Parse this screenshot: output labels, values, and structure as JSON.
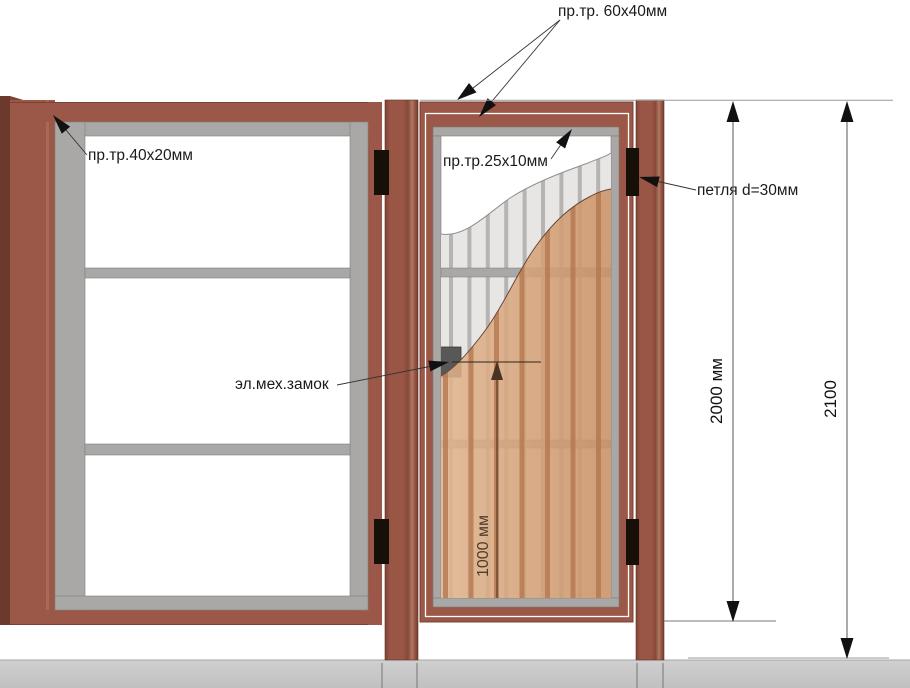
{
  "diagram": {
    "type": "fence-and-wicket-gate-technical-drawing",
    "callouts": {
      "top_frame_tube": "пр.тр. 60x40мм",
      "panel_frame_tube": "пр.тр.40x20мм",
      "gate_frame_tube": "пр.тр.25x10мм",
      "hinge": "петля d=30мм",
      "lock": "эл.мех.замок"
    },
    "dimensions": {
      "gate_height": "2000 мм",
      "overall_height": "2100",
      "lock_height": "1000 мм"
    },
    "colors": {
      "frame_brown": "#9b5747",
      "profile_gray": "#a9a8a6",
      "picket_light": "#e7e6e4",
      "picket_stripe": "#b5b4b2",
      "wood_light": "#e0b28a",
      "wood_stripe": "#b3764e",
      "ground_gray": "#c9c9c9",
      "hinge_black": "#171009",
      "lock_gray": "#585858"
    }
  }
}
